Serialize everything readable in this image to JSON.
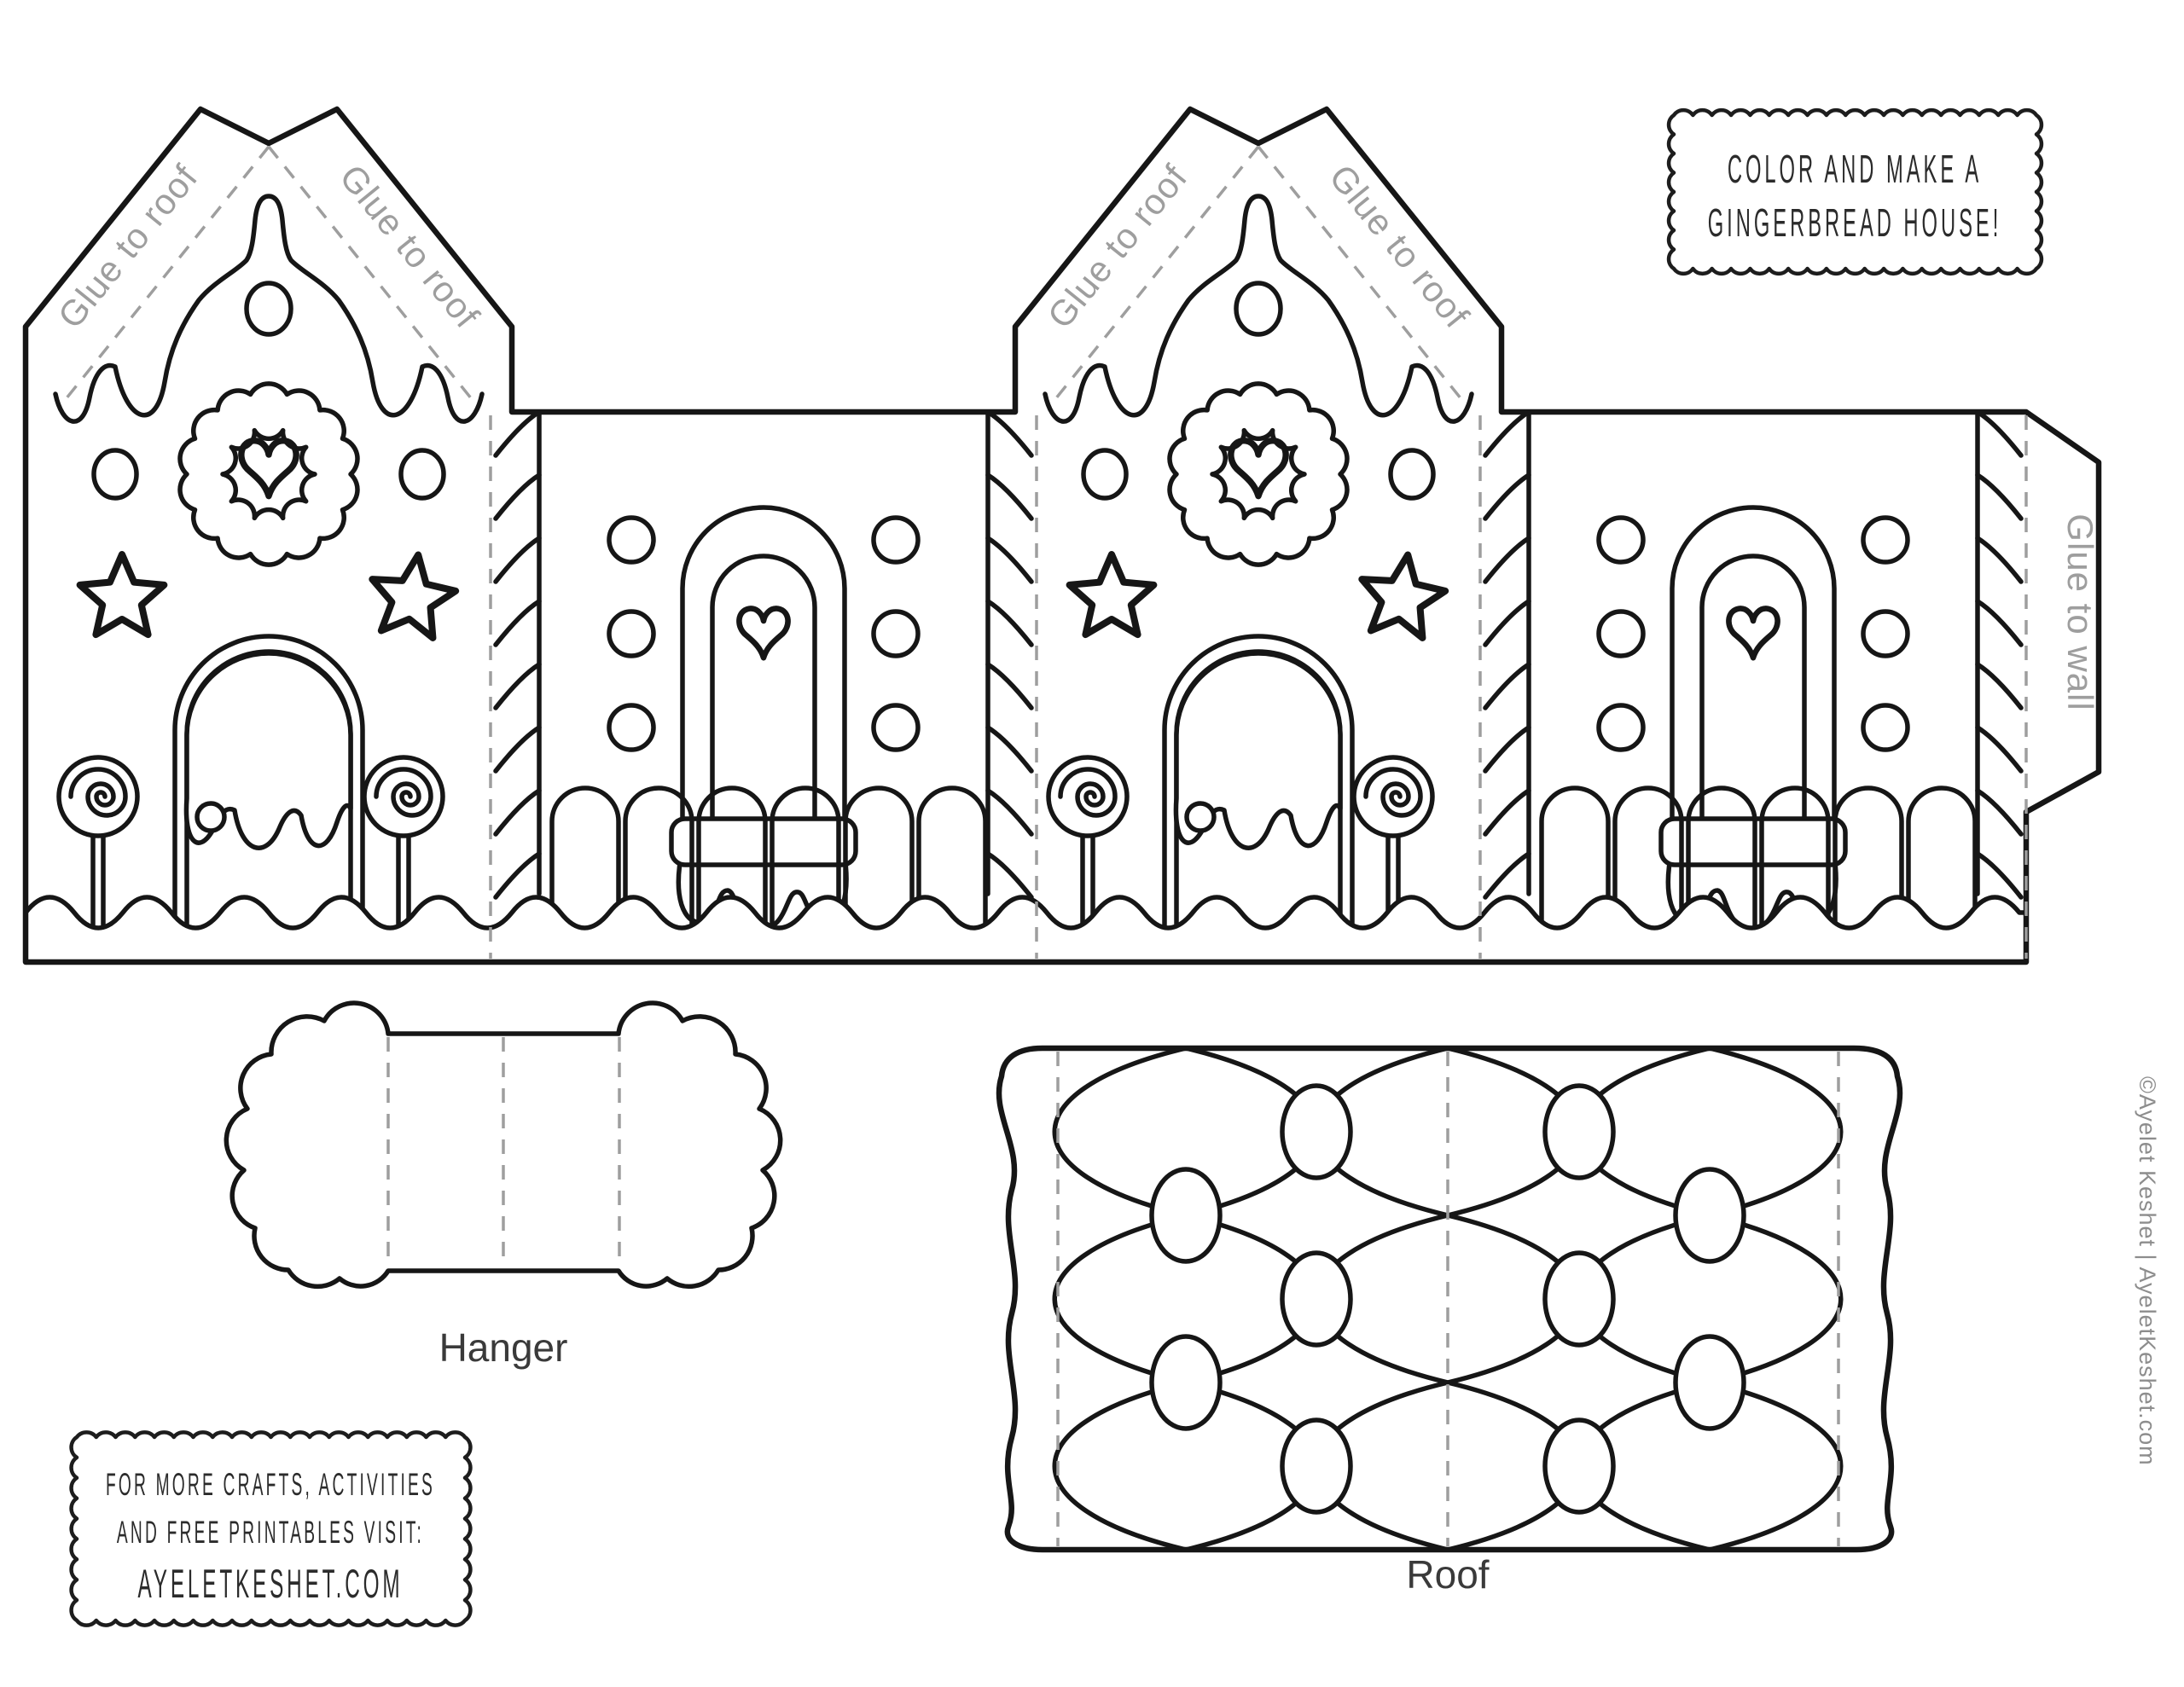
{
  "boxes": {
    "title": {
      "line1": "COLOR AND MAKE A",
      "line2": "GINGERBREAD HOUSE!"
    },
    "promo": {
      "line1": "FOR MORE CRAFTS, ACTIVITIES",
      "line2": "AND FREE PRINTABLES VISIT:",
      "line3": "AYELETKESHET.COM"
    }
  },
  "template": {
    "glue_to_roof": "Glue to roof",
    "glue_to_wall": "Glue to wall"
  },
  "pieces": {
    "hanger_label": "Hanger",
    "roof_label": "Roof"
  },
  "credit": {
    "text": "©Ayelet Keshet | AyeletKeshet.com"
  },
  "colors": {
    "line": "#161616",
    "fold_line": "#9e9e9e",
    "glue_label": "#9e9e9e",
    "piece_label": "#3a3a3a",
    "box_text": "#2b2b2b",
    "credit_text": "#8d8d8d",
    "background": "#ffffff"
  }
}
